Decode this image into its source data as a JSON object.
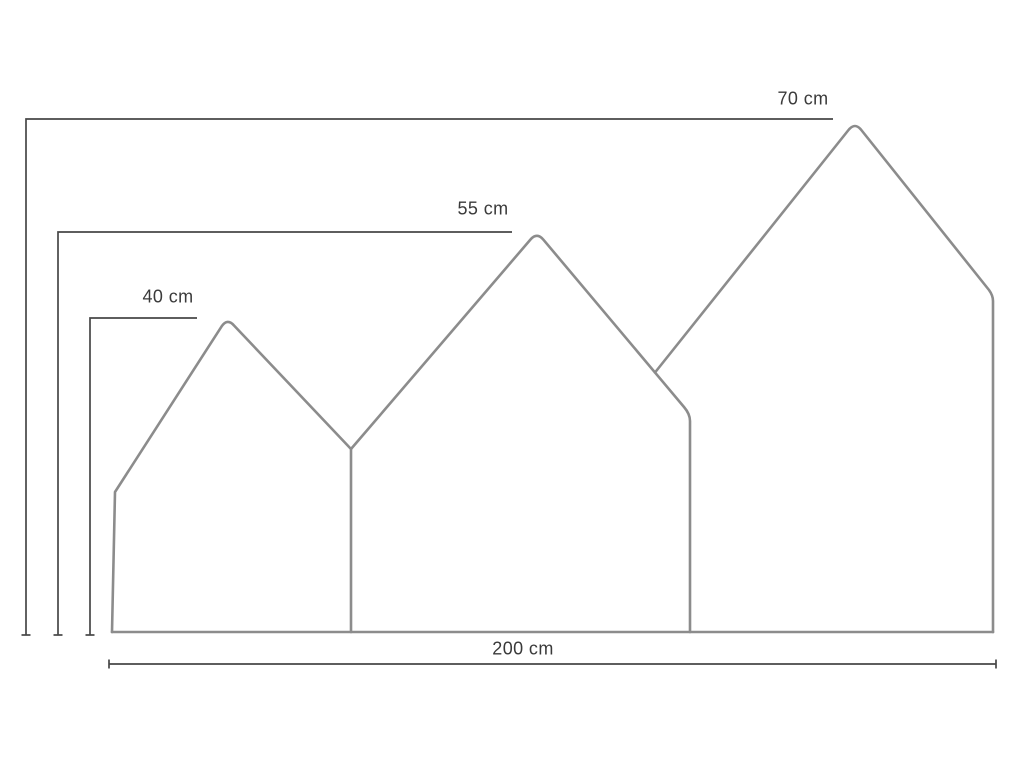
{
  "page": {
    "background": "#ffffff"
  },
  "diagram": {
    "description": "Dimension drawing of a three-peak house-shaped panel headboard",
    "labels": {
      "height_large": "70 cm",
      "height_medium": "55 cm",
      "height_small": "40 cm",
      "width_total": "200 cm"
    },
    "colors": {
      "outline": "#8c8c8c",
      "dimension": "#474747",
      "text": "#3a3a3a"
    }
  }
}
